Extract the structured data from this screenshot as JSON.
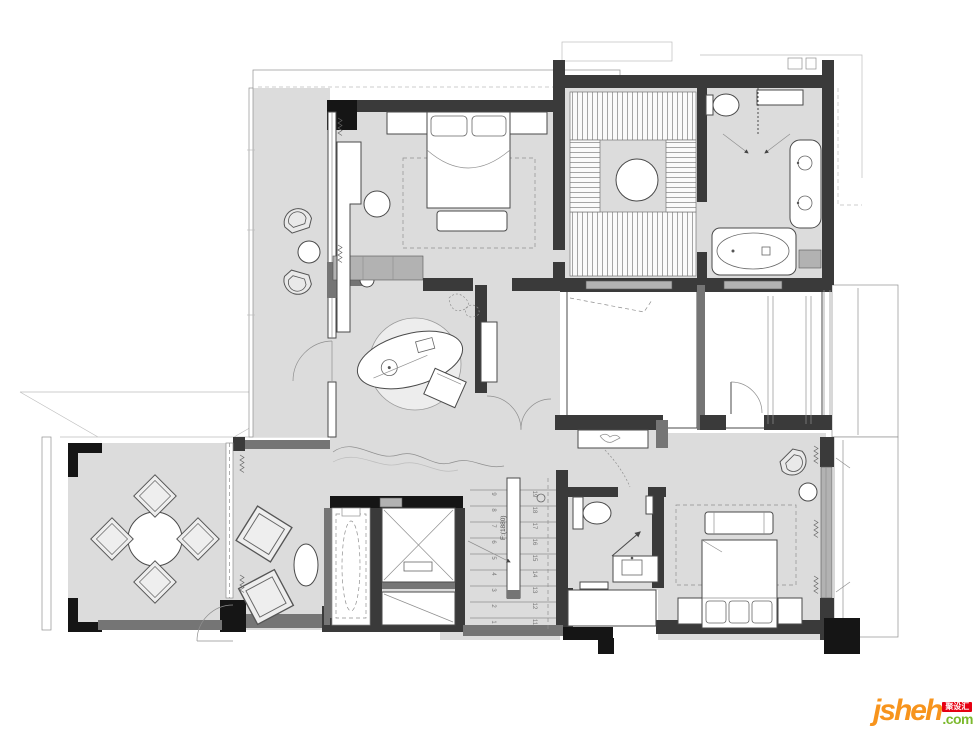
{
  "palette": {
    "background": "#ffffff",
    "floor": "#dcdcdc",
    "floor_light": "#ececec",
    "rug": "#e9e9e9",
    "wall_dark": "#3a3a3a",
    "wall_black": "#151515",
    "wall_mid": "#757575",
    "wall_light": "#b2b2b2",
    "line": "#4a4a4a",
    "logo_orange": "#f7941d",
    "logo_green": "#7cb92e",
    "logo_red": "#e60012"
  },
  "stairs": {
    "annotation": "F:(1880)",
    "lower_numbers": [
      "1",
      "2",
      "3",
      "4",
      "5",
      "6",
      "7",
      "8",
      "9"
    ],
    "upper_numbers": [
      "11",
      "12",
      "13",
      "14",
      "15",
      "16",
      "17",
      "18",
      "19"
    ]
  },
  "logo": {
    "word": "jsheh",
    "badge": "聚设汇",
    "tld": ".com"
  }
}
